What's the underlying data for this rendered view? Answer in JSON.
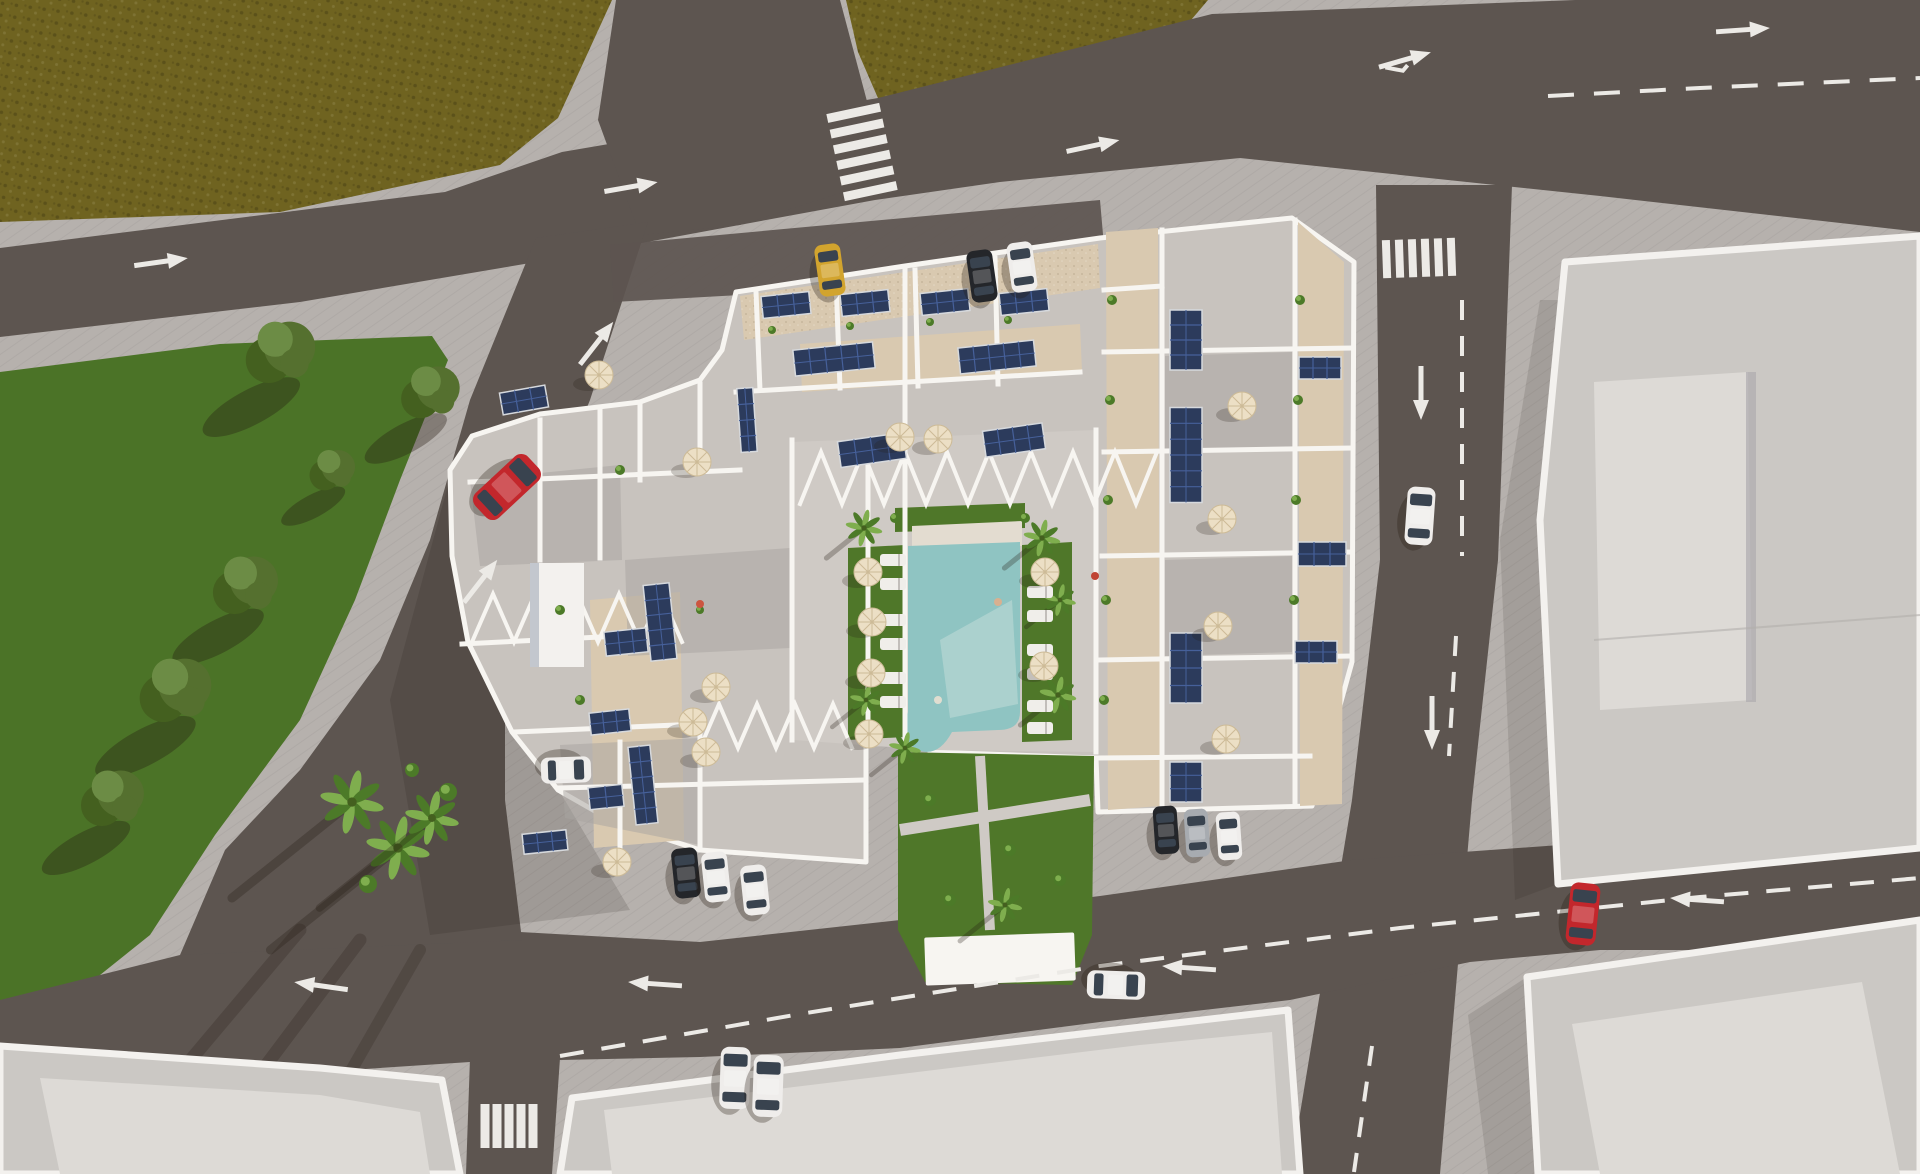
{
  "colors": {
    "sidewalk": "#b6b1ad",
    "sidewalk_line": "#a7a19d",
    "road": "#5d5550",
    "field": "#6f6320",
    "field_dark": "#5c511a",
    "field_light": "#7d7028",
    "lawn": "#4b7327",
    "lawn_dark": "#3c5e1e",
    "island_ring": "#cac5c0",
    "marking": "#eceae6",
    "complex_base": "#c8c3be",
    "terrace_shade": "#a8a39f",
    "gravel": "#d9c9b0",
    "wall": "#f7f5f1",
    "deck": "#cfcac5",
    "garden": "#4f7729",
    "pool": "#8fc4c2",
    "pool_light": "#c2ddd8",
    "coping": "#e3dcd0",
    "umbrella": "#ecdfc5",
    "umbrella_rib": "#cdbb97",
    "solar": "#2c3b5c",
    "solar_cell": "#46609a",
    "solar_frame": "#d6d9dd",
    "tree": "#55702f",
    "tree_dark": "#44601f",
    "tree_light": "#6c8c45",
    "palm": "#4c7a28",
    "palm_light": "#7fae4e",
    "shadow": "#241a12",
    "building": "#cbc8c4",
    "building_inner": "#dddad6",
    "building_face": "#c3c7ce",
    "parapet": "#f3f1ee",
    "seam": "#b2afab",
    "lounger": "#f0eeea",
    "car_red": "#c3272c",
    "car_yellow": "#d2a42e",
    "car_black": "#24262a",
    "car_white": "#efedeb",
    "car_silver": "#a7abb0",
    "car_glass": "#39434f"
  },
  "scene": {
    "description": "Aerial 3D architectural render: residential apartment complex with rooftop terraces, solar panels, umbrellas, central courtyard pool and gardens, surrounded by roads with lane markings, lawns, palm island and neighboring flat-roof buildings",
    "cars": [
      {
        "c": "car_red",
        "x": 507,
        "y": 487,
        "rot": 47,
        "w": 34,
        "l": 72
      },
      {
        "c": "car_red",
        "x": 1583,
        "y": 914,
        "rot": 6,
        "w": 30,
        "l": 62
      },
      {
        "c": "car_white",
        "x": 1420,
        "y": 516,
        "rot": 4,
        "w": 28,
        "l": 58
      },
      {
        "c": "car_white",
        "x": 735,
        "y": 1078,
        "rot": 2,
        "w": 30,
        "l": 62
      },
      {
        "c": "car_white",
        "x": 768,
        "y": 1086,
        "rot": 2,
        "w": 30,
        "l": 62
      },
      {
        "c": "car_white",
        "x": 1116,
        "y": 985,
        "rot": 92,
        "w": 28,
        "l": 58
      },
      {
        "c": "car_yellow",
        "x": 830,
        "y": 270,
        "rot": -8,
        "w": 26,
        "l": 52
      },
      {
        "c": "car_black",
        "x": 982,
        "y": 276,
        "rot": -8,
        "w": 26,
        "l": 52
      },
      {
        "c": "car_white",
        "x": 1022,
        "y": 267,
        "rot": -8,
        "w": 26,
        "l": 50
      },
      {
        "c": "car_black",
        "x": 686,
        "y": 873,
        "rot": -6,
        "w": 26,
        "l": 50
      },
      {
        "c": "car_white",
        "x": 716,
        "y": 877,
        "rot": -6,
        "w": 26,
        "l": 50
      },
      {
        "c": "car_white",
        "x": 755,
        "y": 890,
        "rot": -6,
        "w": 26,
        "l": 50
      },
      {
        "c": "car_white",
        "x": 566,
        "y": 770,
        "rot": 88,
        "w": 26,
        "l": 50
      },
      {
        "c": "car_black",
        "x": 1166,
        "y": 830,
        "rot": -4,
        "w": 24,
        "l": 48
      },
      {
        "c": "car_silver",
        "x": 1197,
        "y": 833,
        "rot": -4,
        "w": 24,
        "l": 48
      },
      {
        "c": "car_white",
        "x": 1229,
        "y": 836,
        "rot": -4,
        "w": 24,
        "l": 48
      }
    ],
    "solar_panels": [
      {
        "x": 786,
        "y": 305,
        "w": 48,
        "h": 22,
        "rot": -6
      },
      {
        "x": 865,
        "y": 303,
        "w": 48,
        "h": 22,
        "rot": -6
      },
      {
        "x": 945,
        "y": 302,
        "w": 48,
        "h": 22,
        "rot": -6
      },
      {
        "x": 1024,
        "y": 302,
        "w": 48,
        "h": 22,
        "rot": -6
      },
      {
        "x": 834,
        "y": 359,
        "w": 80,
        "h": 26,
        "rot": -6
      },
      {
        "x": 997,
        "y": 357,
        "w": 76,
        "h": 26,
        "rot": -6
      },
      {
        "x": 872,
        "y": 450,
        "w": 66,
        "h": 26,
        "rot": -8
      },
      {
        "x": 1014,
        "y": 440,
        "w": 60,
        "h": 26,
        "rot": -8
      },
      {
        "x": 747,
        "y": 420,
        "w": 16,
        "h": 64,
        "rot": -4
      },
      {
        "x": 660,
        "y": 622,
        "w": 26,
        "h": 76,
        "rot": -6
      },
      {
        "x": 626,
        "y": 642,
        "w": 42,
        "h": 24,
        "rot": -6
      },
      {
        "x": 610,
        "y": 722,
        "w": 40,
        "h": 22,
        "rot": -6
      },
      {
        "x": 643,
        "y": 785,
        "w": 22,
        "h": 78,
        "rot": -6
      },
      {
        "x": 606,
        "y": 797,
        "w": 34,
        "h": 22,
        "rot": -6
      },
      {
        "x": 524,
        "y": 400,
        "w": 46,
        "h": 22,
        "rot": -10
      },
      {
        "x": 545,
        "y": 842,
        "w": 44,
        "h": 20,
        "rot": -6
      },
      {
        "x": 1186,
        "y": 340,
        "w": 32,
        "h": 60,
        "rot": 0
      },
      {
        "x": 1186,
        "y": 455,
        "w": 32,
        "h": 95,
        "rot": 0
      },
      {
        "x": 1186,
        "y": 668,
        "w": 32,
        "h": 70,
        "rot": 0
      },
      {
        "x": 1186,
        "y": 782,
        "w": 32,
        "h": 40,
        "rot": 0
      },
      {
        "x": 1322,
        "y": 554,
        "w": 48,
        "h": 24,
        "rot": 0
      },
      {
        "x": 1316,
        "y": 652,
        "w": 42,
        "h": 22,
        "rot": 0
      },
      {
        "x": 1320,
        "y": 368,
        "w": 42,
        "h": 22,
        "rot": 0
      }
    ],
    "umbrellas": [
      {
        "x": 599,
        "y": 375
      },
      {
        "x": 697,
        "y": 462
      },
      {
        "x": 716,
        "y": 687
      },
      {
        "x": 693,
        "y": 722
      },
      {
        "x": 706,
        "y": 752
      },
      {
        "x": 617,
        "y": 862
      },
      {
        "x": 868,
        "y": 572
      },
      {
        "x": 872,
        "y": 622
      },
      {
        "x": 871,
        "y": 673
      },
      {
        "x": 869,
        "y": 734
      },
      {
        "x": 1045,
        "y": 572
      },
      {
        "x": 1044,
        "y": 666
      },
      {
        "x": 900,
        "y": 437
      },
      {
        "x": 938,
        "y": 439
      },
      {
        "x": 1242,
        "y": 406
      },
      {
        "x": 1222,
        "y": 519
      },
      {
        "x": 1218,
        "y": 626
      },
      {
        "x": 1226,
        "y": 739
      }
    ],
    "trees": [
      {
        "x": 280,
        "y": 352,
        "r": 32
      },
      {
        "x": 430,
        "y": 392,
        "r": 27
      },
      {
        "x": 245,
        "y": 585,
        "r": 30
      },
      {
        "x": 175,
        "y": 690,
        "r": 33
      },
      {
        "x": 112,
        "y": 798,
        "r": 29
      },
      {
        "x": 332,
        "y": 470,
        "r": 21
      }
    ],
    "palms": [
      {
        "x": 352,
        "y": 802,
        "s": 26,
        "sh": 160
      },
      {
        "x": 398,
        "y": 848,
        "s": 26,
        "sh": 170
      },
      {
        "x": 432,
        "y": 818,
        "s": 22,
        "sh": 150
      },
      {
        "x": 864,
        "y": 528,
        "s": 15,
        "sh": 50
      },
      {
        "x": 1042,
        "y": 538,
        "s": 15,
        "sh": 50
      },
      {
        "x": 1060,
        "y": 600,
        "s": 13,
        "sh": 45
      },
      {
        "x": 1058,
        "y": 695,
        "s": 15,
        "sh": 50
      },
      {
        "x": 866,
        "y": 700,
        "s": 13,
        "sh": 45
      },
      {
        "x": 905,
        "y": 748,
        "s": 13,
        "sh": 45
      },
      {
        "x": 1005,
        "y": 905,
        "s": 14,
        "sh": 60
      }
    ],
    "loungers": [
      {
        "x": 893,
        "y": 560
      },
      {
        "x": 893,
        "y": 584
      },
      {
        "x": 893,
        "y": 620
      },
      {
        "x": 893,
        "y": 644
      },
      {
        "x": 893,
        "y": 678
      },
      {
        "x": 893,
        "y": 702
      },
      {
        "x": 1040,
        "y": 592
      },
      {
        "x": 1040,
        "y": 616
      },
      {
        "x": 1040,
        "y": 650
      },
      {
        "x": 1040,
        "y": 674
      },
      {
        "x": 1040,
        "y": 706
      },
      {
        "x": 1040,
        "y": 728
      }
    ],
    "planters": [
      [
        772,
        330,
        4
      ],
      [
        850,
        326,
        4
      ],
      [
        930,
        322,
        4
      ],
      [
        1008,
        320,
        4
      ],
      [
        1112,
        300,
        5
      ],
      [
        1110,
        400,
        5
      ],
      [
        1108,
        500,
        5
      ],
      [
        1106,
        600,
        5
      ],
      [
        1104,
        700,
        5
      ],
      [
        1300,
        300,
        5
      ],
      [
        1298,
        400,
        5
      ],
      [
        1296,
        500,
        5
      ],
      [
        1294,
        600,
        5
      ],
      [
        620,
        470,
        5
      ],
      [
        560,
        610,
        5
      ],
      [
        580,
        700,
        5
      ],
      [
        640,
        760,
        5
      ],
      [
        700,
        610,
        4
      ],
      [
        448,
        792,
        9
      ],
      [
        368,
        884,
        9
      ],
      [
        412,
        770,
        7
      ],
      [
        895,
        518,
        5
      ],
      [
        1025,
        518,
        5
      ],
      [
        930,
        800,
        6
      ],
      [
        1010,
        850,
        6
      ],
      [
        1060,
        880,
        6
      ],
      [
        950,
        900,
        6
      ]
    ],
    "people": [
      {
        "x": 998,
        "y": 602,
        "c": "#d8b090"
      },
      {
        "x": 1095,
        "y": 576,
        "c": "#c04434"
      },
      {
        "x": 938,
        "y": 700,
        "c": "#e0ddd0"
      },
      {
        "x": 700,
        "y": 604,
        "c": "#cc5540"
      }
    ],
    "lane_arrows": [
      {
        "x": 160,
        "y": 262,
        "rot": -8
      },
      {
        "x": 630,
        "y": 187,
        "rot": -10
      },
      {
        "x": 1092,
        "y": 146,
        "rot": -12
      },
      {
        "x": 1742,
        "y": 30,
        "rot": -4
      },
      {
        "x": 1404,
        "y": 60,
        "rot": -16,
        "fork": true
      },
      {
        "x": 596,
        "y": 344,
        "rot": -52
      },
      {
        "x": 480,
        "y": 582,
        "rot": -52
      },
      {
        "x": 1421,
        "y": 392,
        "rot": 90
      },
      {
        "x": 1432,
        "y": 722,
        "rot": 90
      },
      {
        "x": 322,
        "y": 986,
        "rot": 188
      },
      {
        "x": 656,
        "y": 984,
        "rot": 184
      },
      {
        "x": 1190,
        "y": 968,
        "rot": 184
      },
      {
        "x": 1698,
        "y": 900,
        "rot": 184
      }
    ],
    "dashes": [
      {
        "pts": "1548,96 1700,88 1920,78",
        "dash": "26 20"
      },
      {
        "pts": "560,1056 800,1014 1100,966 1400,928 1700,897 1920,878",
        "dash": "24 18"
      },
      {
        "pts": "1462,300 1462,556",
        "dash": "20 16"
      },
      {
        "pts": "1456,636 1449,756",
        "dash": "20 16"
      },
      {
        "pts": "1372,1046 1354,1172",
        "dash": "20 16"
      }
    ],
    "crosswalks": [
      {
        "cx": 862,
        "cy": 152,
        "rot": -12,
        "orient": "h",
        "bars": 6,
        "bw": 54,
        "bh": 9,
        "gap": 7
      },
      {
        "cx": 1419,
        "cy": 258,
        "rot": -2,
        "orient": "v",
        "bars": 6,
        "bw": 8,
        "bh": 38,
        "gap": 5
      },
      {
        "cx": 509,
        "cy": 1126,
        "rot": 0,
        "orient": "v",
        "bars": 5,
        "bw": 9,
        "bh": 44,
        "gap": 3
      }
    ]
  }
}
